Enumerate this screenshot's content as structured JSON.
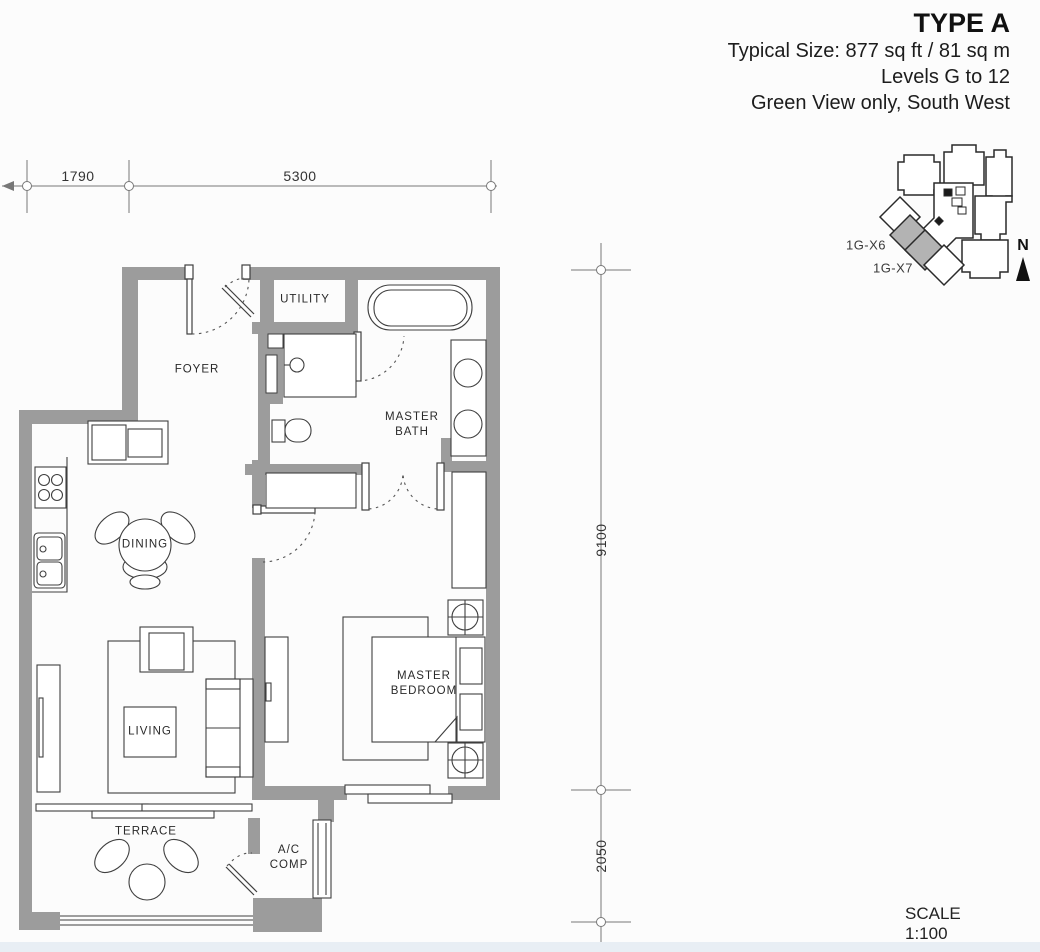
{
  "title_block": {
    "type_name": "TYPE A",
    "size_line": "Typical Size: 877 sq ft / 81 sq m",
    "levels_line": "Levels G to 12",
    "view_line": "Green View only, South West"
  },
  "rooms": {
    "utility": "UTILITY",
    "foyer": "FOYER",
    "master_bath": "MASTER\nBATH",
    "dining": "DINING",
    "living": "LIVING",
    "master_bedroom": "MASTER\nBEDROOM",
    "terrace": "TERRACE",
    "ac_comp": "A/C\nCOMP"
  },
  "dimensions": {
    "top_segment_1": "1790",
    "top_segment_2": "5300",
    "right_segment_1": "9100",
    "right_segment_2": "2050"
  },
  "key_plan": {
    "unit_label_1": "1G-X6",
    "unit_label_2": "1G-X7",
    "north_label": "N",
    "highlight_color": "#b3b3b3"
  },
  "scale_note": "SCALE 1:100",
  "colors": {
    "wall_gray": "#9c9c9c",
    "line_dark": "#3f3f3f",
    "background": "#fcfcfc",
    "footer_band": "#e8eef4"
  }
}
